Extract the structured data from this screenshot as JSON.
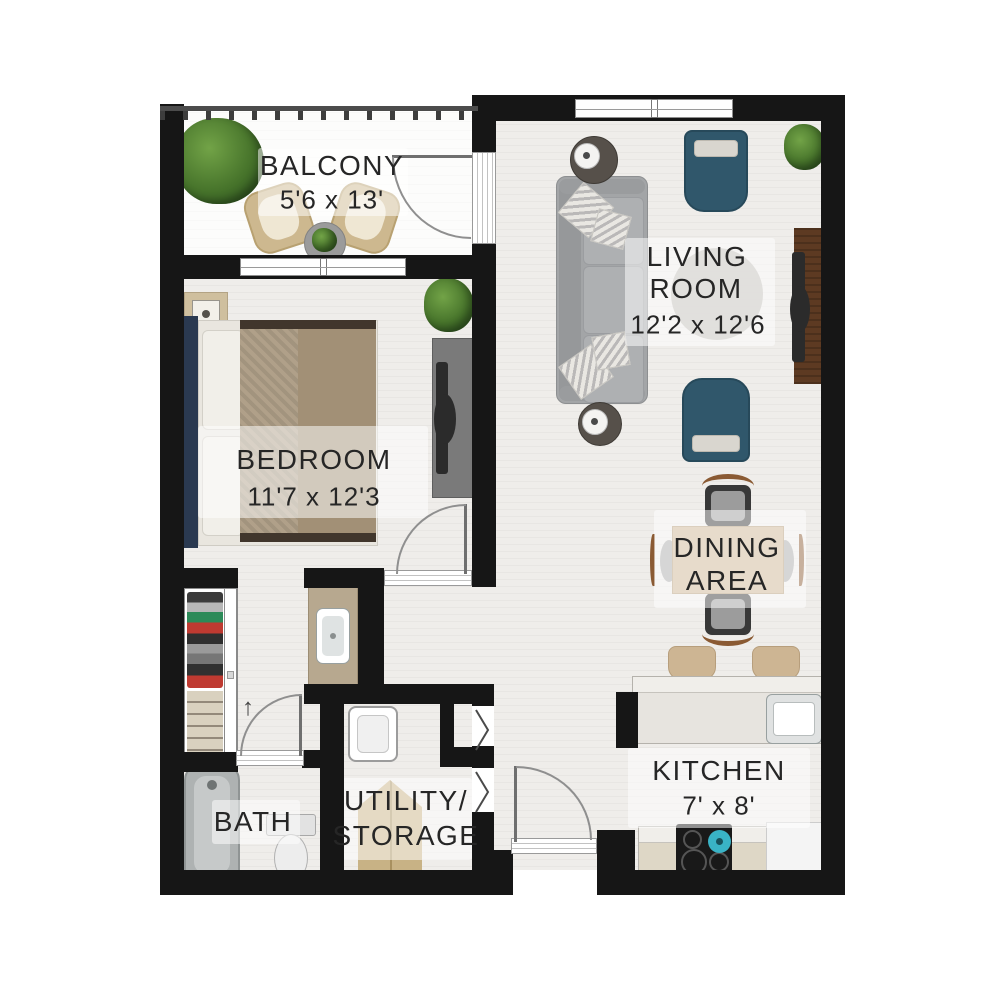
{
  "rooms": {
    "balcony": {
      "name": "BALCONY",
      "dims": "5'6 x 13'"
    },
    "living_room": {
      "line1": "LIVING",
      "line2": "ROOM",
      "dims": "12'2 x 12'6"
    },
    "bedroom": {
      "name": "BEDROOM",
      "dims": "11'7 x 12'3"
    },
    "dining_area": {
      "line1": "DINING",
      "line2": "AREA"
    },
    "kitchen": {
      "name": "KITCHEN",
      "dims": "7' x 8'"
    },
    "bath": {
      "name": "BATH"
    },
    "utility": {
      "line1": "UTILITY/",
      "line2": "STORAGE"
    }
  },
  "annotations": {
    "closet_arrow": "↑"
  },
  "colors": {
    "wall": "#161616",
    "accent_chair_teal": "#30576b",
    "wood_console": "#5d3a22",
    "dining_tan": "#cdb593",
    "kettle_teal": "#39b3c6",
    "bed_headboard_navy": "#2a3950",
    "plant_green": "#47742b"
  }
}
